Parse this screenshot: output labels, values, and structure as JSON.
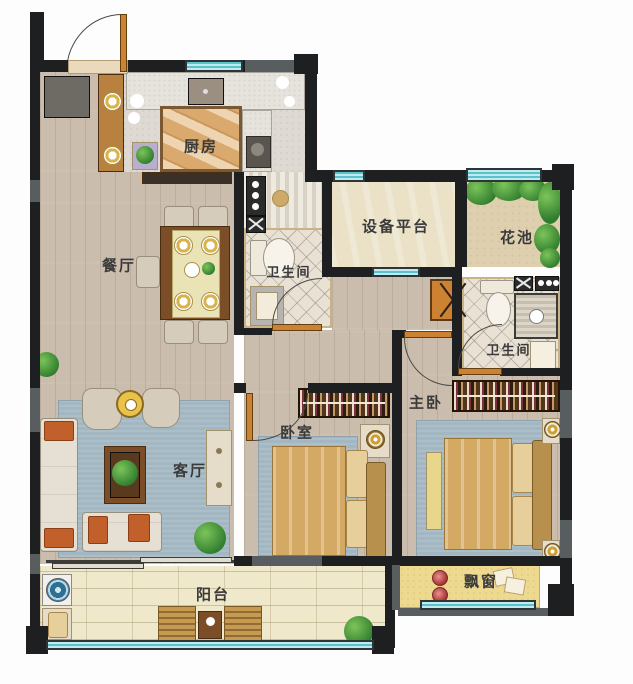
{
  "floorplan": {
    "rooms": {
      "kitchen": {
        "label": "厨房"
      },
      "dining": {
        "label": "餐厅"
      },
      "bath1": {
        "label": "卫生间"
      },
      "equipment": {
        "label": "设备平台"
      },
      "flowerbed": {
        "label": "花池"
      },
      "bath2": {
        "label": "卫生间"
      },
      "master": {
        "label": "主卧"
      },
      "bedroom": {
        "label": "卧室"
      },
      "living": {
        "label": "客厅"
      },
      "balcony": {
        "label": "阳台"
      },
      "baywindow": {
        "label": "飘窗"
      }
    },
    "colors": {
      "wall": "#1e1f20",
      "window_glass": "#58c3cd",
      "window_frame": "#2e3437",
      "wood_floor": "#cbbdad",
      "tile_cream": "#e9e2d4",
      "balcony_tile": "#f0e8ca",
      "bay_window": "#eed990",
      "door": "#cd8233",
      "rug_blue": "#a3b7c2",
      "bed_gold": "#d3a964",
      "plant_green": "#4d9440",
      "sand": "#decfaf"
    }
  }
}
